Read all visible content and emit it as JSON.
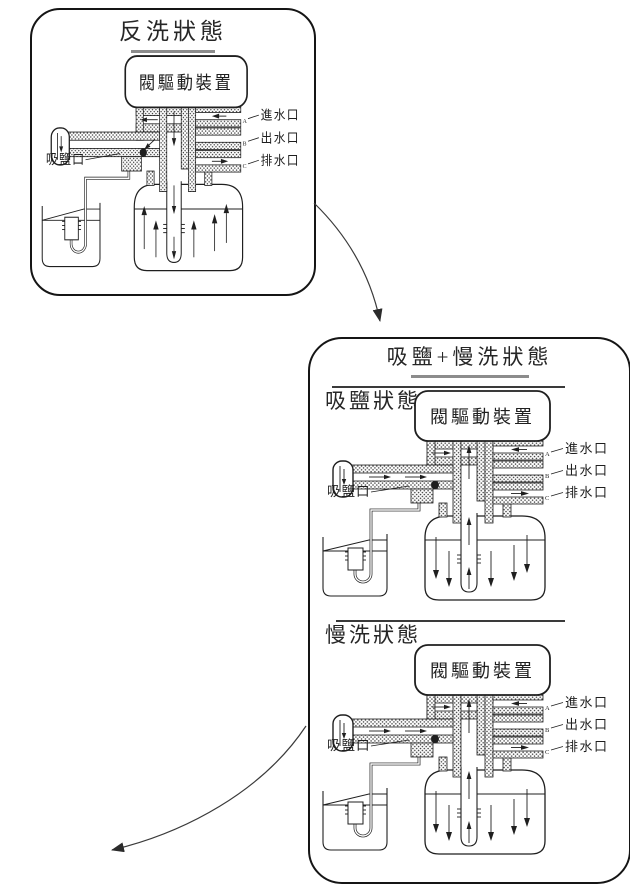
{
  "colors": {
    "ink": "#1f1f1f",
    "title_underline": "#8c8c8c"
  },
  "panel_backwash": {
    "title": "反洗狀態",
    "diagram": {
      "device_label": "閥驅動裝置",
      "brine_port_label": "吸鹽口",
      "ports": [
        {
          "key": "A",
          "label": "進水口"
        },
        {
          "key": "B",
          "label": "出水口"
        },
        {
          "key": "C",
          "label": "排水口"
        }
      ],
      "tank_body_flow": "up",
      "riser_flow": "down",
      "injector_flow": "closed"
    }
  },
  "panel_brine_slow_rinse": {
    "title": "吸鹽+慢洗狀態",
    "sections": [
      {
        "title": "吸鹽狀態",
        "diagram": {
          "device_label": "閥驅動裝置",
          "brine_port_label": "吸鹽口",
          "ports": [
            {
              "key": "A",
              "label": "進水口"
            },
            {
              "key": "B",
              "label": "出水口"
            },
            {
              "key": "C",
              "label": "排水口"
            }
          ],
          "tank_body_flow": "down",
          "riser_flow": "up",
          "injector_flow": "suction"
        }
      },
      {
        "title": "慢洗狀態",
        "diagram": {
          "device_label": "閥驅動裝置",
          "brine_port_label": "吸鹽口",
          "ports": [
            {
              "key": "A",
              "label": "進水口"
            },
            {
              "key": "B",
              "label": "出水口"
            },
            {
              "key": "C",
              "label": "排水口"
            }
          ],
          "tank_body_flow": "down",
          "riser_flow": "up",
          "injector_flow": "suction"
        }
      }
    ]
  }
}
